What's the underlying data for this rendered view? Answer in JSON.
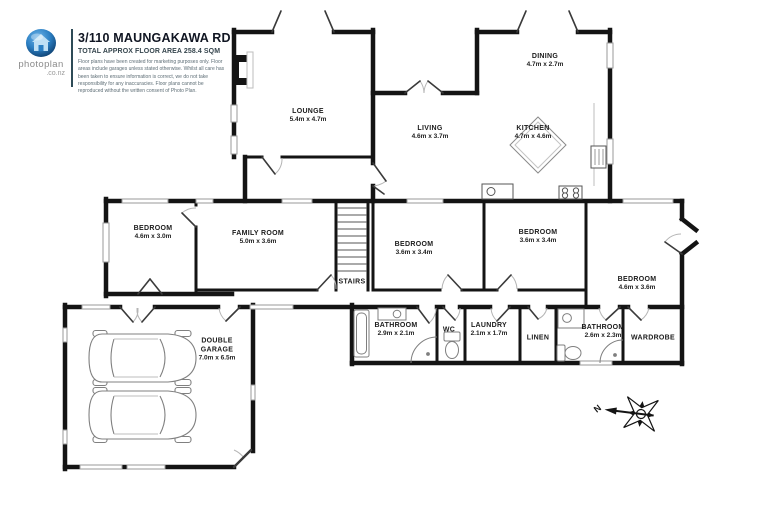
{
  "header": {
    "title": "3/110 MAUNGAKAWA RD",
    "subtitle": "TOTAL APPROX FLOOR AREA 258.4 SQM",
    "disclaimer_lines": [
      "Floor plans have been created for marketing purposes only. Floor",
      "areas include garages unless stated otherwise. Whilst all care has",
      "been taken to ensure information is correct, we do not take",
      "responsibility for any inaccuracies. Floor plans cannot be",
      "reproduced without the written consent of Photo Plan."
    ],
    "logo": {
      "brand": "photoplan",
      "domain": ".co.nz",
      "icon": "house-sphere-icon",
      "sphere_color": "#2b7fc3"
    }
  },
  "compass": {
    "label": "N"
  },
  "rooms": [
    {
      "id": "lounge",
      "name_lines": [
        "LOUNGE"
      ],
      "dims": "5.4m x 4.7m",
      "x": 308,
      "y": 116
    },
    {
      "id": "dining",
      "name_lines": [
        "DINING"
      ],
      "dims": "4.7m x 2.7m",
      "x": 545,
      "y": 61
    },
    {
      "id": "living",
      "name_lines": [
        "LIVING"
      ],
      "dims": "4.6m x 3.7m",
      "x": 430,
      "y": 133
    },
    {
      "id": "kitchen",
      "name_lines": [
        "KITCHEN"
      ],
      "dims": "4.7m x 4.6m",
      "x": 533,
      "y": 133
    },
    {
      "id": "bedroom-1",
      "name_lines": [
        "BEDROOM"
      ],
      "dims": "4.6m x 3.0m",
      "x": 153,
      "y": 233
    },
    {
      "id": "family-room",
      "name_lines": [
        "FAMILY ROOM"
      ],
      "dims": "5.0m x 3.6m",
      "x": 258,
      "y": 238
    },
    {
      "id": "bedroom-2",
      "name_lines": [
        "BEDROOM"
      ],
      "dims": "3.6m x 3.4m",
      "x": 414,
      "y": 249
    },
    {
      "id": "bedroom-3",
      "name_lines": [
        "BEDROOM"
      ],
      "dims": "3.6m x 3.4m",
      "x": 538,
      "y": 237
    },
    {
      "id": "bedroom-4",
      "name_lines": [
        "BEDROOM"
      ],
      "dims": "4.6m x 3.6m",
      "x": 637,
      "y": 284
    },
    {
      "id": "stairs",
      "name_lines": [
        "STAIRS"
      ],
      "dims": "",
      "x": 352,
      "y": 282
    },
    {
      "id": "bathroom-1",
      "name_lines": [
        "BATHROOM"
      ],
      "dims": "2.9m x 2.1m",
      "x": 396,
      "y": 330
    },
    {
      "id": "wc",
      "name_lines": [
        "WC"
      ],
      "dims": "",
      "x": 449,
      "y": 330
    },
    {
      "id": "laundry",
      "name_lines": [
        "LAUNDRY"
      ],
      "dims": "2.1m x 1.7m",
      "x": 489,
      "y": 330
    },
    {
      "id": "linen",
      "name_lines": [
        "LINEN"
      ],
      "dims": "",
      "x": 538,
      "y": 338
    },
    {
      "id": "bathroom-2",
      "name_lines": [
        "BATHROOM"
      ],
      "dims": "2.6m x 2.3m",
      "x": 603,
      "y": 332
    },
    {
      "id": "wardrobe",
      "name_lines": [
        "WARDROBE"
      ],
      "dims": "",
      "x": 653,
      "y": 338
    },
    {
      "id": "double-garage",
      "name_lines": [
        "DOUBLE",
        "GARAGE"
      ],
      "dims": "7.0m x 6.5m",
      "x": 217,
      "y": 350
    }
  ],
  "colors": {
    "wall": "#141414",
    "window": "#9a9a9a",
    "door_leaf": "#3a3a3a",
    "door_arc": "#b5b5b5",
    "fixture": "#7f7f7f",
    "logo_blue": "#2b7fc3",
    "divider": "#2e4b57"
  }
}
